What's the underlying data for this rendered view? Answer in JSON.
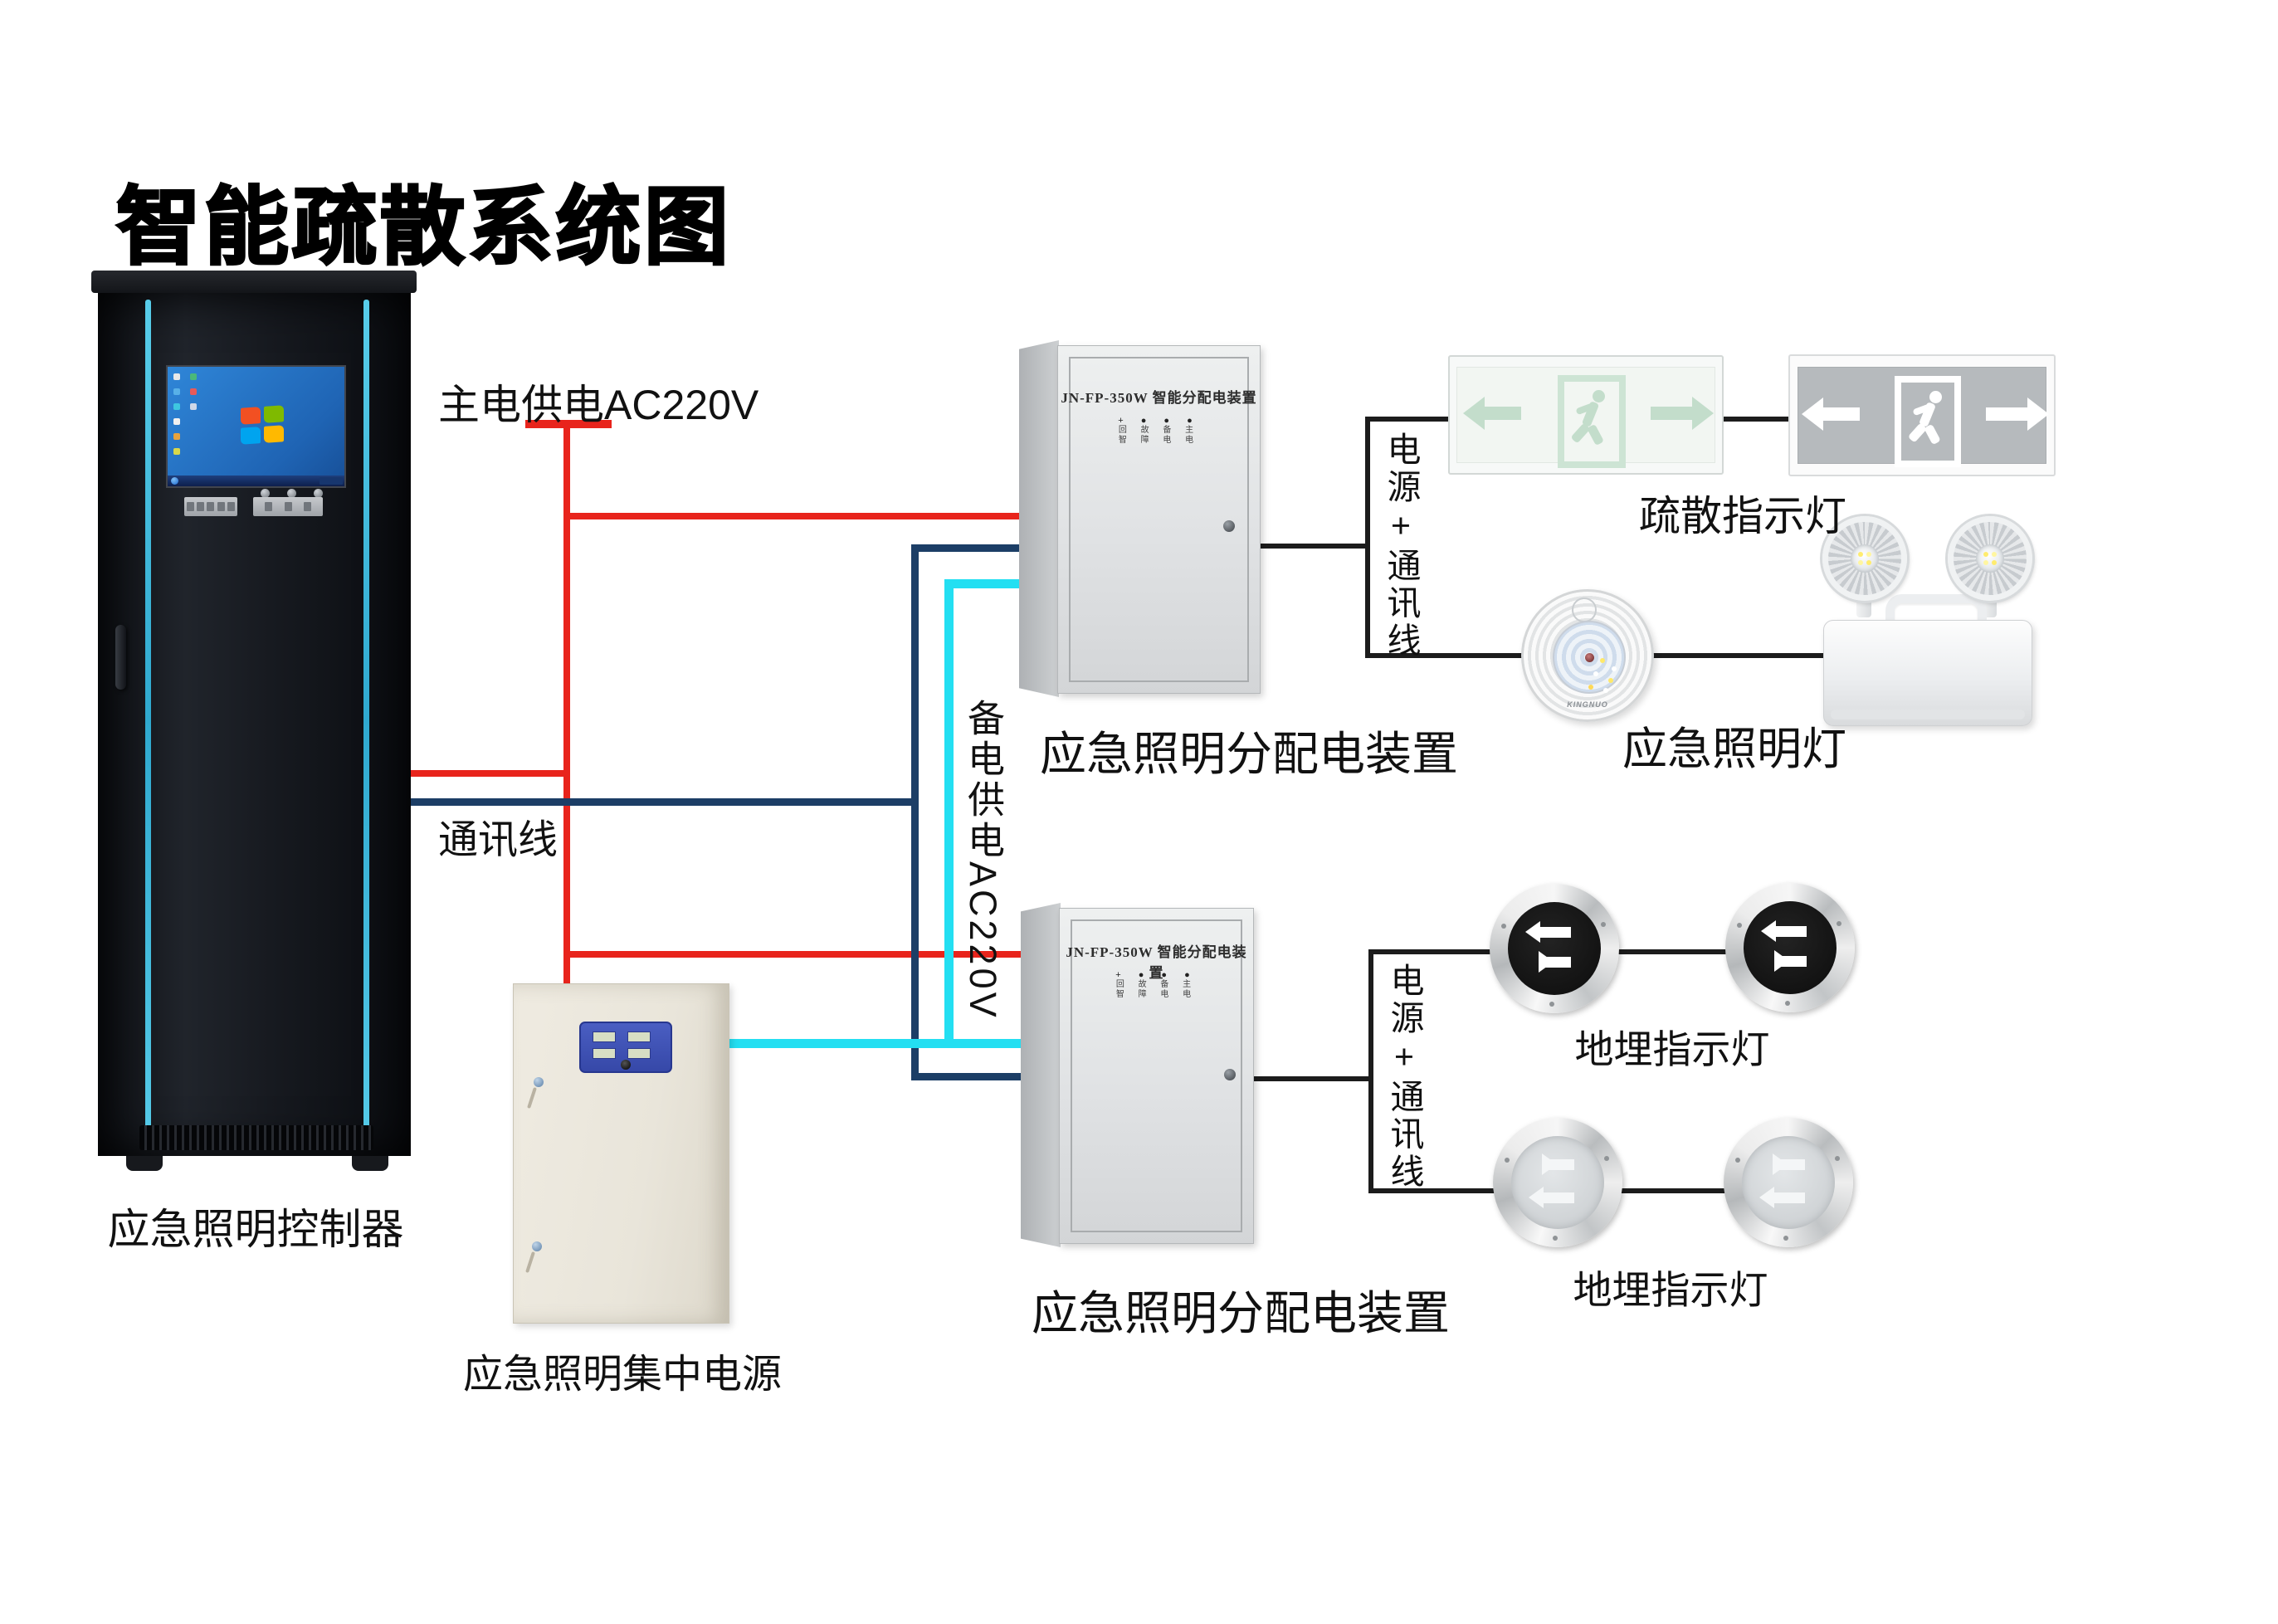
{
  "title": "智能疏散系统图",
  "colors": {
    "main_power_line": "#e8241c",
    "comm_line": "#1c3e66",
    "backup_power_line": "#23dff2",
    "connector_line": "#1c1c1c",
    "cabinet_accent": "#58cdea"
  },
  "wires": {
    "main_power": "主电供电AC220V",
    "backup_power": "备电供电AC220V",
    "comm": "通讯线",
    "power_comm": "电源+通讯线"
  },
  "cabinet": {
    "label": "应急照明控制器"
  },
  "power_supply": {
    "label": "应急照明集中电源"
  },
  "dist_box": {
    "title": "JN-FP-350W 智能分配电装置",
    "indicator_row1": "回 故 备 主",
    "indicator_row2": "智 障 电 电",
    "label": "应急照明分配电装置"
  },
  "lights": {
    "exit_sign_label": "疏散指示灯",
    "emergency_label": "应急照明灯",
    "ground_label": "地埋指示灯",
    "ceiling_brand": "KINGNUO"
  }
}
